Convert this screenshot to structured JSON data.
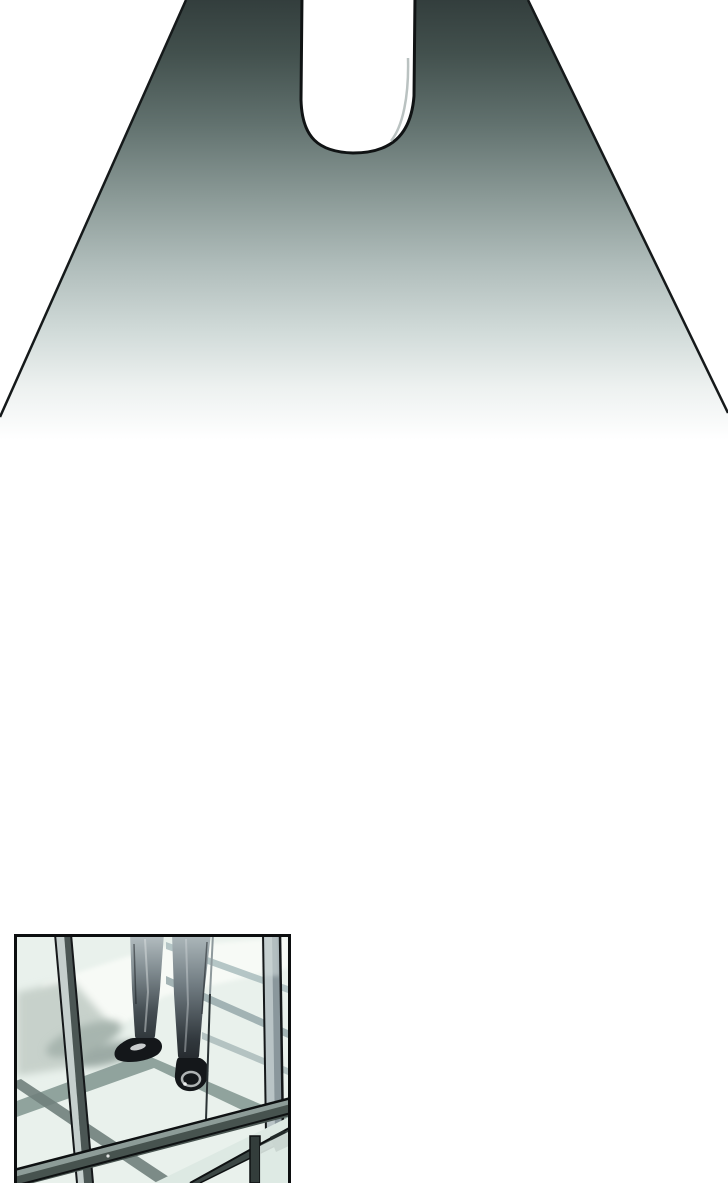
{
  "page": {
    "kind": "webtoon-comic-strip-segment",
    "background": "#ffffff",
    "visible_text": []
  },
  "scene": {
    "top_beam": {
      "description": "Wide spotlight beam of dark teal light widening downward and fading to white, with a rounded elongated notch silhouette cut out of its top center"
    },
    "floor_panel": {
      "description": "Comic panel showing a man's legs in dark trousers and black dress shoes standing on a glass floor of a steel-framed structure, with diagonal beam shadows cast across the pale green glass"
    }
  },
  "palette": {
    "page_bg": "#ffffff",
    "ink": "#101314",
    "beam_top": "#333e3d",
    "beam_mid": "#8b9a97",
    "glass": "#e9f1ec",
    "glass_bright": "#f7faf6",
    "pane": "#dde9e3",
    "shadow_soft": "#c7d1cb",
    "shadow_band": "#8b9e99",
    "shadow_deep": "#70807c",
    "band_light": "#a9bcbd",
    "steel_light": "#c5cfcd",
    "steel_dark": "#4b5654",
    "beam_steel": "#47534f",
    "beam_steel_top": "#8d9c98",
    "frame_dark": "#3c4745",
    "suit_dark": "#1e2327",
    "shoe_black": "#14171a"
  }
}
